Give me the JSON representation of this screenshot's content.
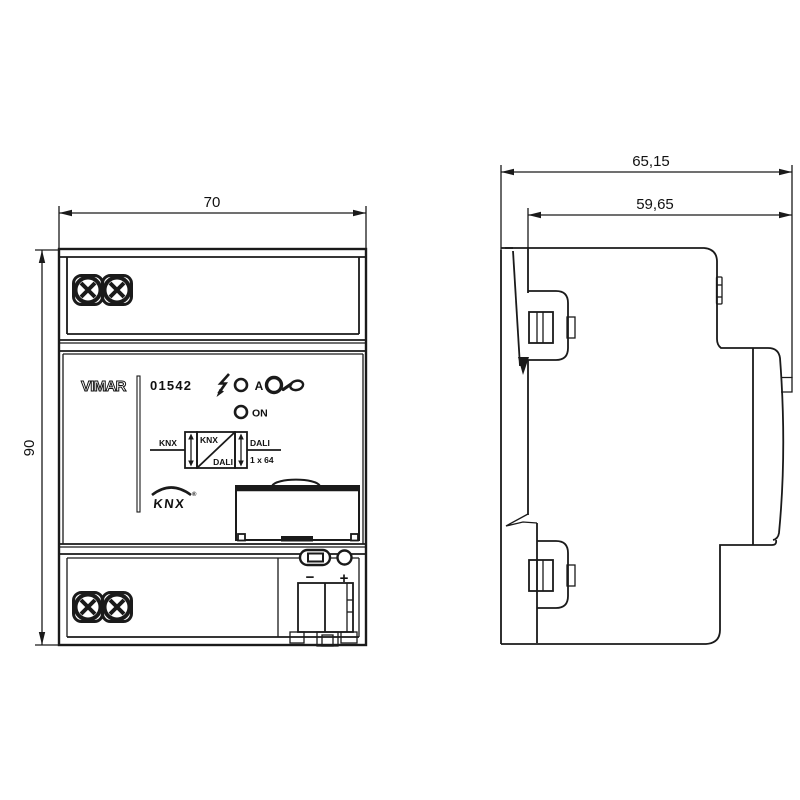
{
  "front": {
    "brand": "VIMAR",
    "code": "01542",
    "indicators": {
      "a_label": "A",
      "on_label": "ON"
    },
    "gateway_diagram": {
      "left_bus": "KNX",
      "box_top": "KNX",
      "box_bottom": "DALI",
      "right_bus": "DALI",
      "capacity": "1 x 64"
    },
    "knx_logo": {
      "text": "KNX",
      "registered": "®"
    },
    "polarity": {
      "minus": "−",
      "plus": "+"
    }
  },
  "dimensions": {
    "width_mm": "70",
    "height_mm": "90",
    "depth_total_mm": "65,15",
    "depth_body_mm": "59,65"
  },
  "icons": {
    "lightning_icon": "lightning-bolt-shape",
    "led_icon": "○",
    "pushbutton_icon": "◯",
    "hand_press_icon": "pointing-hand-shape",
    "screw_head_icon": "x-slot-screw-shape"
  }
}
